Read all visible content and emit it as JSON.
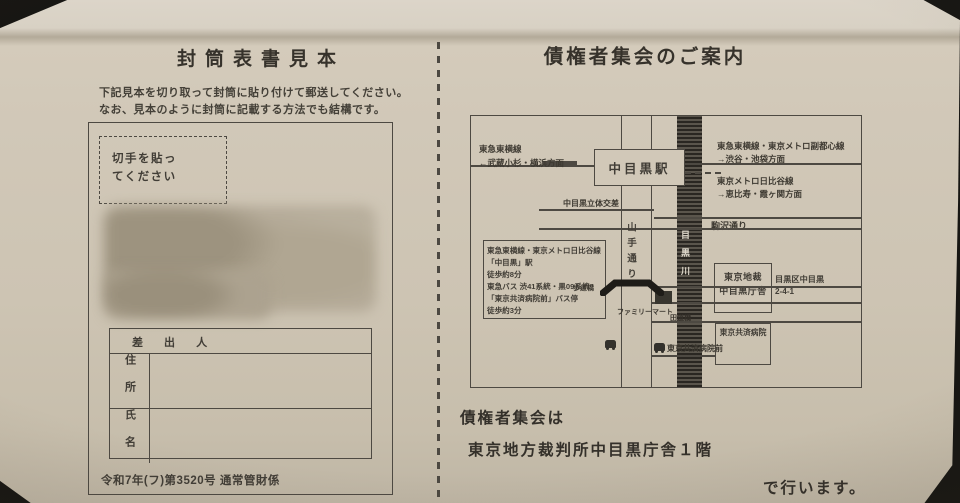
{
  "photo": {
    "paper_color": "#cfc6b6",
    "ink_color": "#3d3931"
  },
  "left_panel": {
    "title": "封筒表書見本",
    "instruction_1": "下記見本を切り取って封筒に貼り付けて郵送してください。",
    "instruction_2": "なお、見本のように封筒に記載する方法でも結構です。",
    "envelope": {
      "stamp_note": "切手を貼っ\nてください",
      "sender_header": "差 出 人",
      "address_label": "住所",
      "name_label": "氏名",
      "case_number": "令和7年(フ)第3520号 通常管財係"
    }
  },
  "right_panel": {
    "title": "債権者集会のご案内",
    "map": {
      "station_label": "中目黒駅",
      "toyoko_west_line1": "東急東横線",
      "toyoko_west_line2": "←武蔵小杉・横浜方面",
      "toyoko_east_line1": "東急東横線・東京メトロ副都心線",
      "toyoko_east_line2": "→渋谷・池袋方面",
      "hibiya_east_line1": "東京メトロ日比谷線",
      "hibiya_east_line2": "→恵比寿・霞ヶ関方面",
      "grade_separation": "中目黒立体交差",
      "komazawa_street": "駒沢通り",
      "yamate_street": "山手通り",
      "meguro_river": "目黒川",
      "access_line1": "東急東横線・東京メトロ日比谷線",
      "access_line2": "「中目黒」駅",
      "access_line3": "徒歩約8分",
      "access_line4": "東急バス 渋41系統・黒09系統",
      "access_line5": "「東京共済病院前」バス停",
      "access_line6": "徒歩約3分",
      "pedestrian_bridge": "歩道橋",
      "familymart": "ファミリーマート",
      "dento_bridge": "田道橋",
      "court_line1": "東京地裁",
      "court_line2": "中目黒庁舎",
      "court_address_line1": "目黒区中目黒",
      "court_address_line2": "2-4-1",
      "hospital": "東京共済病院",
      "bus_stop": "東京共済病院前"
    },
    "footer_line1": "債権者集会は",
    "footer_line2": "東京地方裁判所中目黒庁舎１階",
    "footer_line3": "で行います。"
  }
}
